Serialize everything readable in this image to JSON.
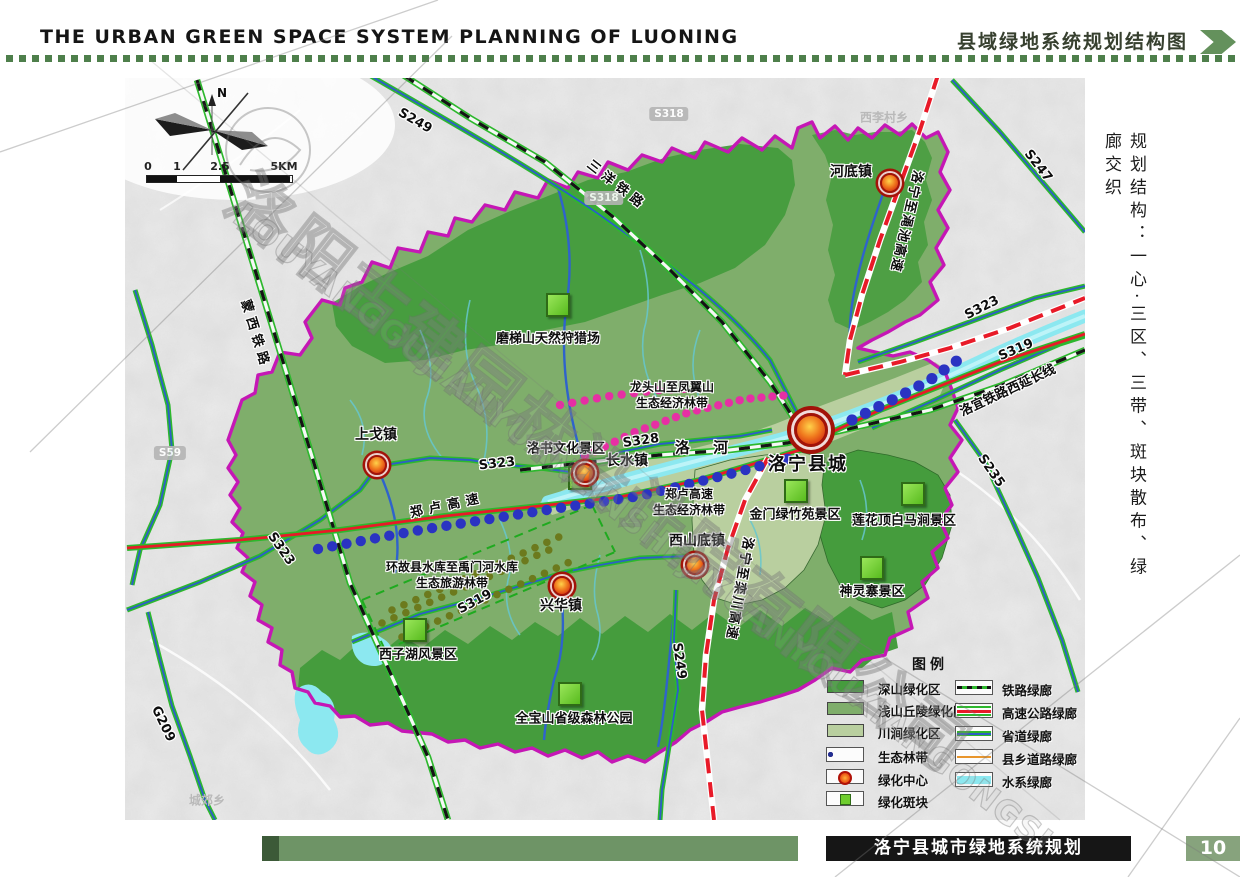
{
  "header": {
    "title_en": "THE URBAN GREEN SPACE SYSTEM PLANNING OF LUONING",
    "title_cn": "县域绿地系统规划结构图"
  },
  "side_note": "规划结构：一心·三区、三带、斑块散布、绿廊交织",
  "compass_label": "N",
  "scale": {
    "t0": "0",
    "t1": "1",
    "t2": "2.5",
    "t3": "5KM"
  },
  "watermark": {
    "cn": "洛阳古建园林设计院有限公司",
    "en": "LOUYANGGUJIANYUANLINSHEJIYUANYOUXIANGONGSI"
  },
  "map": {
    "towns": {
      "hedi": "河底镇",
      "shangge": "上戈镇",
      "changshui": "长水镇",
      "xishandi": "西山底镇",
      "xinghua": "兴华镇",
      "county_seat": "洛宁县城"
    },
    "sites": {
      "hunting": "磨梯山天然狩猎场",
      "luoshu": "洛书文化景区",
      "jinmen": "金门绿竹苑景区",
      "lianhua": "莲花顶白马涧景区",
      "shenling": "神灵寨景区",
      "xizihu": "西子湖风景区",
      "quanbao": "全宝山省级森林公园"
    },
    "belts": {
      "longtou_1": "龙头山至凤翼山",
      "longtou_2": "生态经济林带",
      "zhenglu_1": "郑卢高速",
      "zhenglu_2": "生态经济林带",
      "guxian_1": "环故县水库至禹门河水库",
      "guxian_2": "生态旅游林带"
    },
    "roads": {
      "s249_n": "S249",
      "s249_s": "S249",
      "s318_a": "S318",
      "s318_b": "S318",
      "s247": "S247",
      "s323_w": "S323",
      "s323_mid": "S323",
      "s323_e": "S323",
      "s328": "S328",
      "s319_s": "S319",
      "s319_e": "S319",
      "s235": "S235",
      "s59": "S59",
      "g209": "G209"
    },
    "railways": {
      "sanyang": "三洋铁路",
      "mengxi": "蒙西铁路",
      "luoyi": "洛宜铁路西延长线"
    },
    "highways": {
      "zhenglu": "郑卢高速",
      "mianchi": "洛宁至渑池高速",
      "luanchuan": "洛宁至栾川高速"
    },
    "river": "洛 河",
    "bg_labels": {
      "xilicun": "西李村乡",
      "chengjiao": "城郊乡"
    }
  },
  "legend": {
    "title": "图例",
    "areas": [
      {
        "label": "深山绿化区",
        "color": "#459c3d"
      },
      {
        "label": "浅山丘陵绿化区",
        "color": "#7fae6b"
      },
      {
        "label": "川涧绿化区",
        "color": "#b9cf9f"
      }
    ],
    "symbols": [
      {
        "label": "生态林带"
      },
      {
        "label": "绿化中心"
      },
      {
        "label": "绿化斑块"
      }
    ],
    "corridors": [
      {
        "label": "铁路绿廊"
      },
      {
        "label": "高速公路绿廊"
      },
      {
        "label": "省道绿廊"
      },
      {
        "label": "县乡道路绿廊"
      },
      {
        "label": "水系绿廊"
      }
    ]
  },
  "footer": {
    "title": "洛宁县城市绿地系统规划",
    "page": "10"
  },
  "colors": {
    "boundary": "#c517b5",
    "deep_green": "#459c3d",
    "hill_green": "#7fae6b",
    "valley_green": "#b9cf9f",
    "water_cyan": "#8ce8f0",
    "highway_red": "#e81a28",
    "road_green": "#2db82d",
    "road_core_blue": "#2d5fc4",
    "belt_pink": "#e62fa4",
    "belt_blue": "#2a33c2",
    "belt_olive": "#6c7a1d",
    "patch_green": "#6fce2e",
    "marker_red": "#c41808",
    "county_road_orange": "#e8952c"
  }
}
